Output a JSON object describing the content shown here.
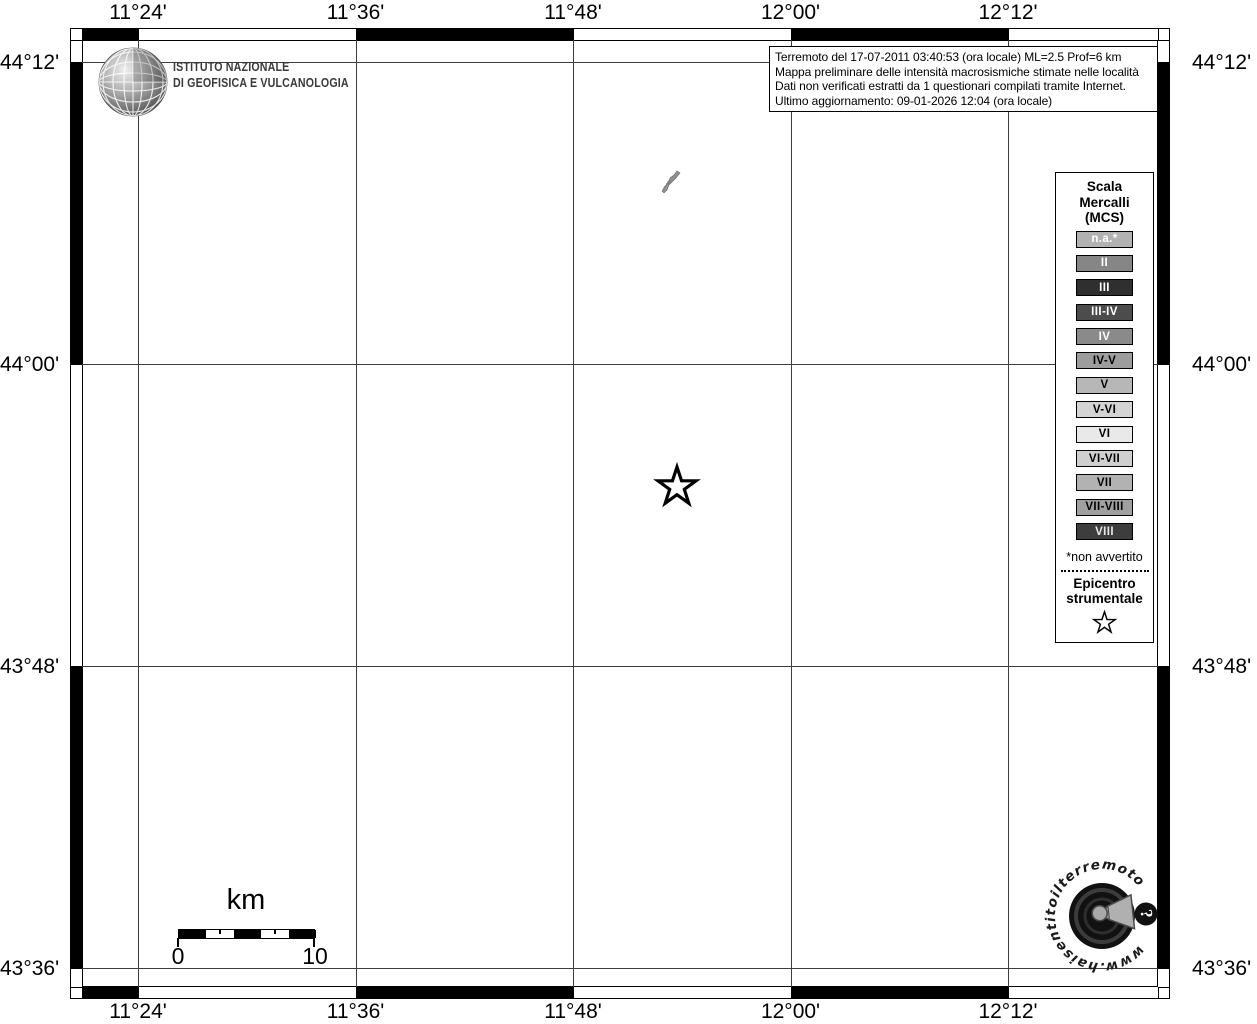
{
  "info_box": {
    "lines": [
      "Terremoto del 17-07-2011 03:40:53 (ora locale) ML=2.5 Prof=6 km",
      "Mappa preliminare delle intensità macrosismiche stimate nelle località",
      "Dati non verificati estratti da 1 questionari compilati tramite Internet.",
      "Ultimo aggiornamento: 09-01-2026 12:04 (ora locale)"
    ]
  },
  "axes": {
    "lon_labels": [
      "11°24'",
      "11°36'",
      "11°48'",
      "12°00'",
      "12°12'"
    ],
    "lat_labels": [
      "44°12'",
      "44°00'",
      "43°48'",
      "43°36'"
    ]
  },
  "ingv": {
    "name_line1": "ISTITUTO NAZIONALE",
    "name_line2": "DI GEOFISICA E VULCANOLOGIA"
  },
  "legend": {
    "title_lines": [
      "Scala",
      "Mercalli",
      "(MCS)"
    ],
    "items": [
      {
        "label": "n.a.*",
        "bg": "#b2b2b2",
        "fg": "#ffffff"
      },
      {
        "label": "II",
        "bg": "#868686",
        "fg": "#ffffff"
      },
      {
        "label": "III",
        "bg": "#2f2f2f",
        "fg": "#ffffff"
      },
      {
        "label": "III-IV",
        "bg": "#4c4c4c",
        "fg": "#ffffff"
      },
      {
        "label": "IV",
        "bg": "#8a8a8a",
        "fg": "#ffffff"
      },
      {
        "label": "IV-V",
        "bg": "#9d9d9d",
        "fg": "#000000"
      },
      {
        "label": "V",
        "bg": "#b7b7b7",
        "fg": "#000000"
      },
      {
        "label": "V-VI",
        "bg": "#d4d4d4",
        "fg": "#000000"
      },
      {
        "label": "VI",
        "bg": "#e9e9e9",
        "fg": "#000000"
      },
      {
        "label": "VI-VII",
        "bg": "#cfcfcf",
        "fg": "#000000"
      },
      {
        "label": "VII",
        "bg": "#b2b2b2",
        "fg": "#000000"
      },
      {
        "label": "VII-VIII",
        "bg": "#a0a0a0",
        "fg": "#000000"
      },
      {
        "label": "VIII",
        "bg": "#3d3d3d",
        "fg": "#e8e8e8"
      }
    ],
    "footnote": "*non avvertito",
    "epicenter_lines": [
      "Epicentro",
      "strumentale"
    ]
  },
  "scale_bar": {
    "unit": "km",
    "start_label": "0",
    "end_label": "10"
  },
  "watermark": {
    "url": "www.haisentitoilterremoto.it",
    "badge": "?"
  },
  "colors": {
    "frame": "#000000",
    "grid": "#3d3d3d",
    "epicenter_stroke": "#000000",
    "epicenter_fill": "#ffffff"
  }
}
